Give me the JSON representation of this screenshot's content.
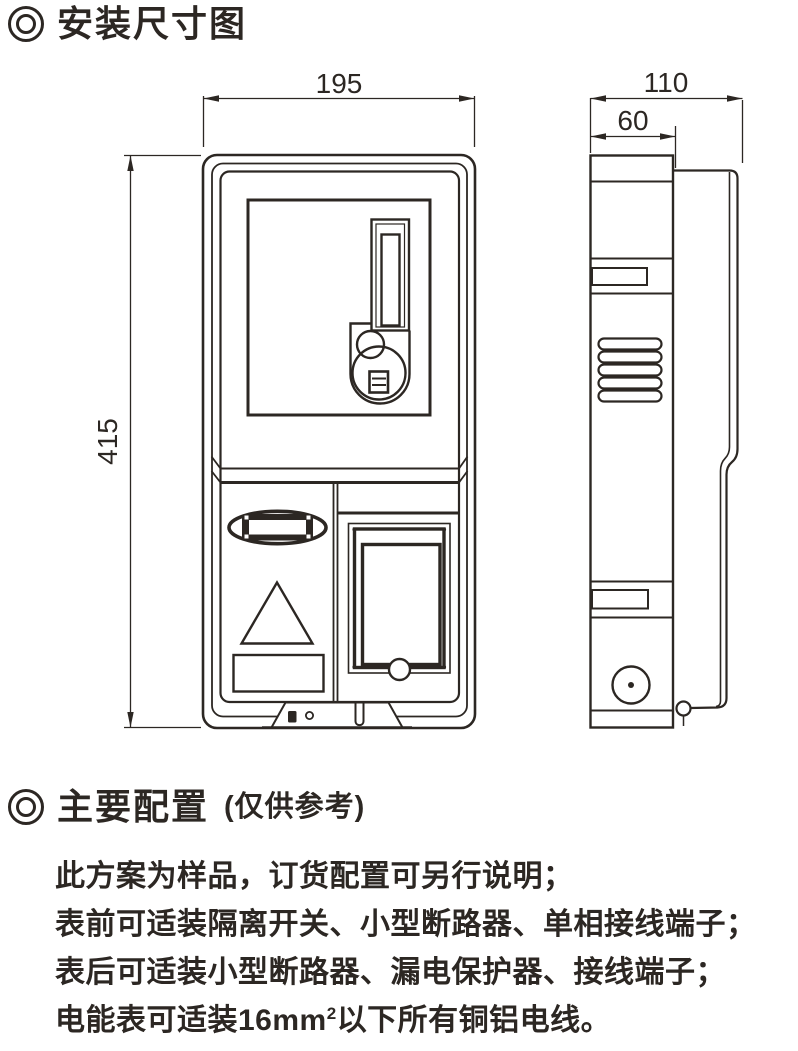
{
  "colors": {
    "ink": "#2c2723",
    "background": "#ffffff"
  },
  "sections": {
    "install_title": "安装尺寸图",
    "config_title": "主要配置",
    "config_subtitle": "(仅供参考)"
  },
  "dimensions": {
    "front_width_mm": "195",
    "front_height_mm": "415",
    "side_total_depth_mm": "110",
    "side_body_depth_mm": "60"
  },
  "notes": {
    "line1": "此方案为样品，订货配置可另行说明；",
    "line2": "表前可适装隔离开关、小型断路器、单相接线端子；",
    "line3": "表后可适装小型断路器、漏电保护器、接线端子；",
    "line4_prefix": "电能表可适装16mm",
    "line4_superscript": "2",
    "line4_suffix": "以下所有铜铝电线。"
  }
}
